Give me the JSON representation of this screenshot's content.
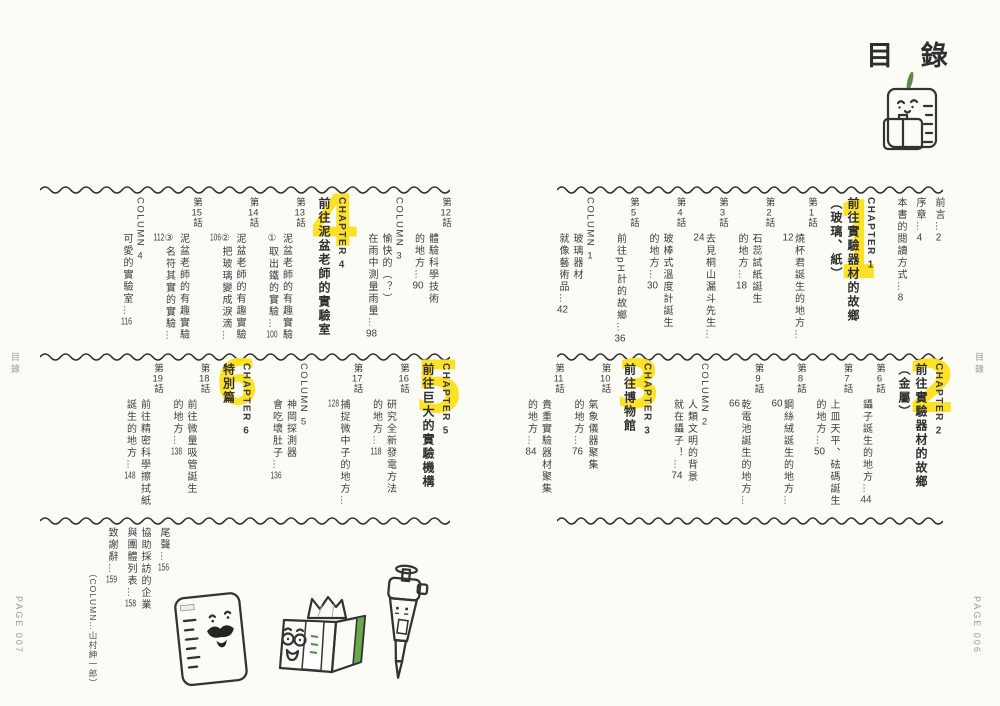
{
  "header": {
    "title": "目 錄"
  },
  "margins": {
    "toc_left": "目錄",
    "toc_right": "目錄",
    "page_left": "PAGE 007",
    "page_right": "PAGE 006"
  },
  "colors": {
    "accent_yellow": "#ffdf1c",
    "text": "#3c3c3c",
    "margin_green": "#8fa092"
  },
  "right_page": {
    "front_matter": [
      "前言…2",
      "序章…4",
      "本書的閱讀方式…8"
    ],
    "chapter1": {
      "num": "1",
      "label": "CHAPTER 1",
      "title": "前往實驗器材的故鄉",
      "subtitle": "（玻璃、紙）"
    },
    "chapter1_episodes": [
      {
        "label": "第1話",
        "lines": [
          "燒杯君誕生的地方…12"
        ]
      },
      {
        "label": "第2話",
        "lines": [
          "石蕊試紙誕生",
          "的地方…18"
        ]
      },
      {
        "label": "第3話",
        "lines": [
          "去見桐山漏斗先生…24"
        ]
      },
      {
        "label": "第4話",
        "lines": [
          "玻棒式溫度計誕生",
          "的地方…30"
        ]
      },
      {
        "label": "第5話",
        "lines": [
          "前往pH計的故鄉…36"
        ]
      }
    ],
    "column1": {
      "label": "COLUMN 1",
      "lines": [
        "玻璃器材",
        "就像藝術品…42"
      ]
    },
    "chapter2": {
      "num": "2",
      "label": "CHAPTER 2",
      "title": "前往實驗器材的故鄉",
      "subtitle": "（金屬）"
    },
    "chapter2_episodes": [
      {
        "label": "第6話",
        "lines": [
          "鑷子誕生的地方…44"
        ]
      },
      {
        "label": "第7話",
        "lines": [
          "上皿天平、砝碼誕生",
          "的地方…50"
        ]
      },
      {
        "label": "第8話",
        "lines": [
          "鋼絲絨誕生的地方…60"
        ]
      },
      {
        "label": "第9話",
        "lines": [
          "乾電池誕生的地方…66"
        ]
      }
    ],
    "column2": {
      "label": "COLUMN 2",
      "lines": [
        "人類文明的背景",
        "就在鑷子！…74"
      ]
    },
    "chapter3": {
      "num": "3",
      "label": "CHAPTER 3",
      "title": "前往博物館"
    },
    "chapter3_episodes": [
      {
        "label": "第10話",
        "lines": [
          "氣象儀器聚集",
          "的地方…76"
        ]
      },
      {
        "label": "第11話",
        "lines": [
          "貴重實驗器材聚集",
          "的地方…84"
        ]
      }
    ]
  },
  "left_page": {
    "chapter3_episodes_cont": [
      {
        "label": "第12話",
        "lines": [
          "體驗科學技術",
          "的地方…90"
        ]
      }
    ],
    "column3": {
      "label": "COLUMN 3",
      "lines": [
        "愉快的（？）",
        "在雨中測量雨量…98"
      ]
    },
    "chapter4": {
      "num": "4",
      "label": "CHAPTER 4",
      "title": "前往泥盆老師的實驗室"
    },
    "chapter4_episodes": [
      {
        "label": "第13話",
        "lines": [
          "泥盆老師的有趣實驗",
          "①取出鐵的實驗…100"
        ]
      },
      {
        "label": "第14話",
        "lines": [
          "泥盆老師的有趣實驗",
          "②把玻璃變成淚滴…106"
        ]
      },
      {
        "label": "第15話",
        "lines": [
          "泥盆老師的有趣實驗",
          "③名符其實的實驗…112"
        ]
      }
    ],
    "column4": {
      "label": "COLUMN 4",
      "lines": [
        "可愛的實驗室…116"
      ]
    },
    "chapter5": {
      "num": "5",
      "label": "CHAPTER 5",
      "title": "前往巨大的實驗機構"
    },
    "chapter5_episodes": [
      {
        "label": "第16話",
        "lines": [
          "研究全新發電方法",
          "的地方…118"
        ]
      },
      {
        "label": "第17話",
        "lines": [
          "捕捉微中子的地方…128"
        ]
      }
    ],
    "column5": {
      "label": "COLUMN 5",
      "lines": [
        "神岡探測器",
        "會吃壞肚子…136"
      ]
    },
    "chapter6": {
      "num": "6",
      "label": "CHAPTER 6",
      "title": "特別篇"
    },
    "chapter6_episodes": [
      {
        "label": "第18話",
        "lines": [
          "前往微量吸管誕生",
          "的地方…138"
        ]
      },
      {
        "label": "第19話",
        "lines": [
          "前往精密科學擦拭紙",
          "誕生的地方…148"
        ]
      }
    ],
    "ending": [
      {
        "lines": [
          "尾聲…156"
        ]
      },
      {
        "lines": [
          "協助採訪的企業",
          "與團體列表…158"
        ]
      },
      {
        "lines": [
          "致謝辭…159"
        ]
      }
    ],
    "column_credit": "（COLUMN…山村紳一郎）"
  },
  "illustrations": {
    "header_icon": "beaker-with-briefcase",
    "footer_icons": [
      "beaker-character",
      "wipes-box",
      "micropipette"
    ]
  }
}
